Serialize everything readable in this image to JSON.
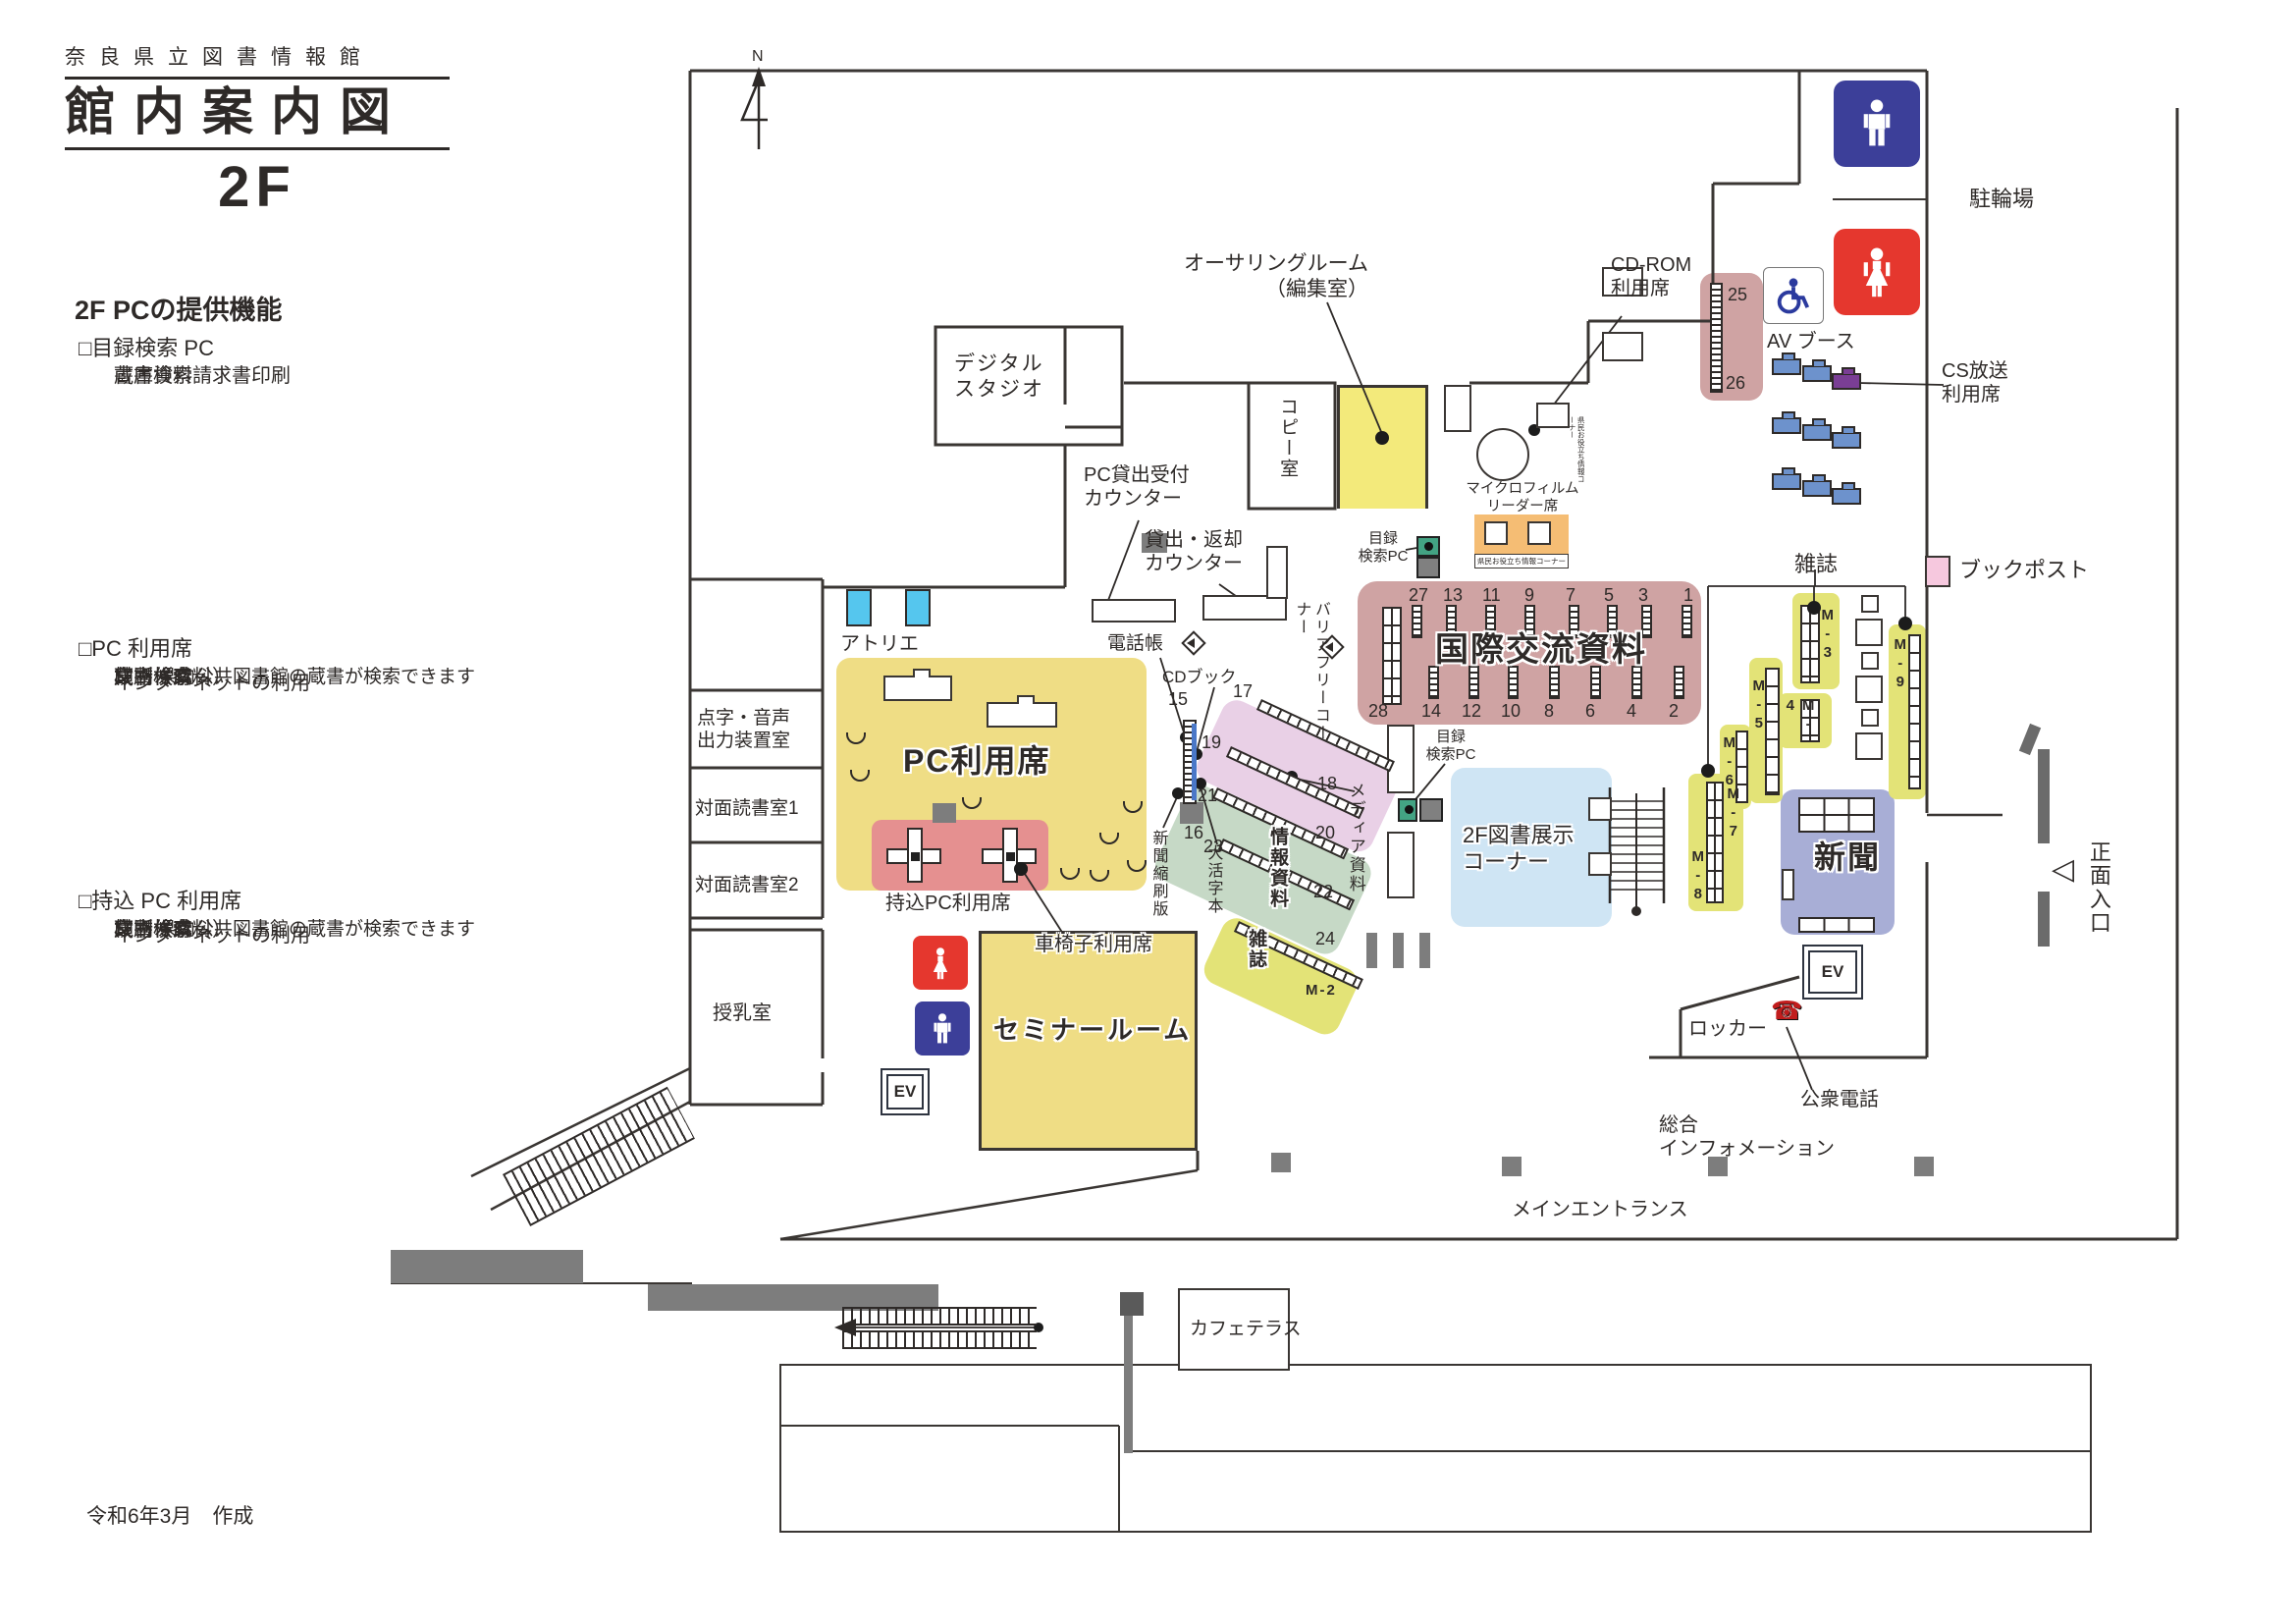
{
  "header": {
    "org": "奈良県立図書情報館",
    "title": "館内案内図",
    "floor": "2F"
  },
  "legend": {
    "heading": "2F PCの提供機能",
    "sections": [
      {
        "title": "□目録検索 PC",
        "items": [
          "蔵書検索",
          "書庫資料請求書印刷"
        ]
      },
      {
        "title": "□PC 利用席",
        "items": [
          "蔵書検索",
          "横断検索",
          "・県内公共図書館の蔵書が検索できます",
          "インターネットの利用",
          "文書作成",
          "印刷（有料）"
        ]
      },
      {
        "title": "□持込 PC 利用席",
        "items": [
          "蔵書検索",
          "横断検索",
          "・県内公共図書館の蔵書が検索できます",
          "インターネットの利用",
          "文書作成",
          "印刷（有料）"
        ]
      }
    ],
    "footer": "令和6年3月　作成"
  },
  "map": {
    "compass": "N",
    "labels": {
      "digital_studio": "デジタル\nスタジオ",
      "authoring": "オーサリングルーム\n（編集室）",
      "copy_room": "コピー室",
      "cdrom_seats": "CD-ROM\n利用席",
      "microfilm": "マイクロフィルム\nリーダー席",
      "kenmin_info": "県民お役立ち情報コーナー",
      "catalog_pc": "目録\n検索PC",
      "pc_lending_counter": "PC貸出受付\nカウンター",
      "lending_return_counter": "貸出・返却\nカウンター",
      "phonebook": "電話帳",
      "cd_book": "CDブック",
      "barrier_free": "バリアフリーコーナー",
      "intl_title": "国際交流資料",
      "av_booth": "AV ブース",
      "cs_broadcast": "CS放送\n利用席",
      "bicycle_parking": "駐輪場",
      "book_post": "ブックポスト",
      "magazines": "雑誌",
      "newspapers": "新聞",
      "display_corner": "2F図書展示\nコーナー",
      "media_materials": "メディア資料",
      "info_materials": "情報資料",
      "newspaper_reduced": "新聞縮刷版",
      "large_print": "大活字本",
      "pc_seats": "PC利用席",
      "bring_pc_seats": "持込PC利用席",
      "wheelchair_seats": "車椅子利用席",
      "seminar_room": "セミナールーム",
      "atelier": "アトリエ",
      "braille_room": "点字・音声\n出力装置室",
      "reading_room1": "対面読書室1",
      "reading_room2": "対面読書室2",
      "nursing_room": "授乳室",
      "cafe_terrace": "カフェテラス",
      "main_entrance": "メインエントランス",
      "front_entrance": "正面入口",
      "locker": "ロッカー",
      "public_phone": "公衆電話",
      "general_info": "総合\nインフォメーション",
      "ev": "EV"
    },
    "numbers": {
      "n15": "15",
      "n16": "16",
      "n17": "17",
      "n18": "18",
      "n19": "19",
      "n20": "20",
      "n21": "21",
      "n22": "22",
      "n23": "23",
      "n24": "24",
      "n25": "25",
      "n26": "26"
    },
    "m": {
      "m2": "M-2",
      "m3": "M-3",
      "m4": "M-4",
      "m5": "M-5",
      "m6": "M-6",
      "m7": "M-7",
      "m8": "M-8",
      "m9": "M-9"
    },
    "intl_top": [
      "27",
      "13",
      "11",
      "9",
      "7",
      "5",
      "3",
      "1"
    ],
    "intl_bottom": [
      "28",
      "14",
      "12",
      "10",
      "8",
      "6",
      "4",
      "2"
    ],
    "icons": {
      "phone": "☎",
      "triangle_left": "◁"
    },
    "colors": {
      "zone_yellow": "#efdd85",
      "room_yellow": "#f3ea7b",
      "shelf_yellow": "#e3e377",
      "bring_pc_red": "#e59090",
      "intl_pink": "#cfa3a3",
      "media_pink": "#e9d0e6",
      "info_green": "#c6d9c6",
      "display_blue": "#cfe5f4",
      "news_periwinkle": "#a8aed6",
      "microfilm_orange": "#f5bd74",
      "bookpost_pink": "#f6c8de",
      "booth_blue": "#6d92cc",
      "cs_purple": "#7a3e95",
      "atelier_blue": "#55c6ee",
      "toilet_blue": "#3c3f99",
      "toilet_red": "#e5372e",
      "pc_green": "#43a383",
      "gray": "#7d7d7d"
    }
  }
}
